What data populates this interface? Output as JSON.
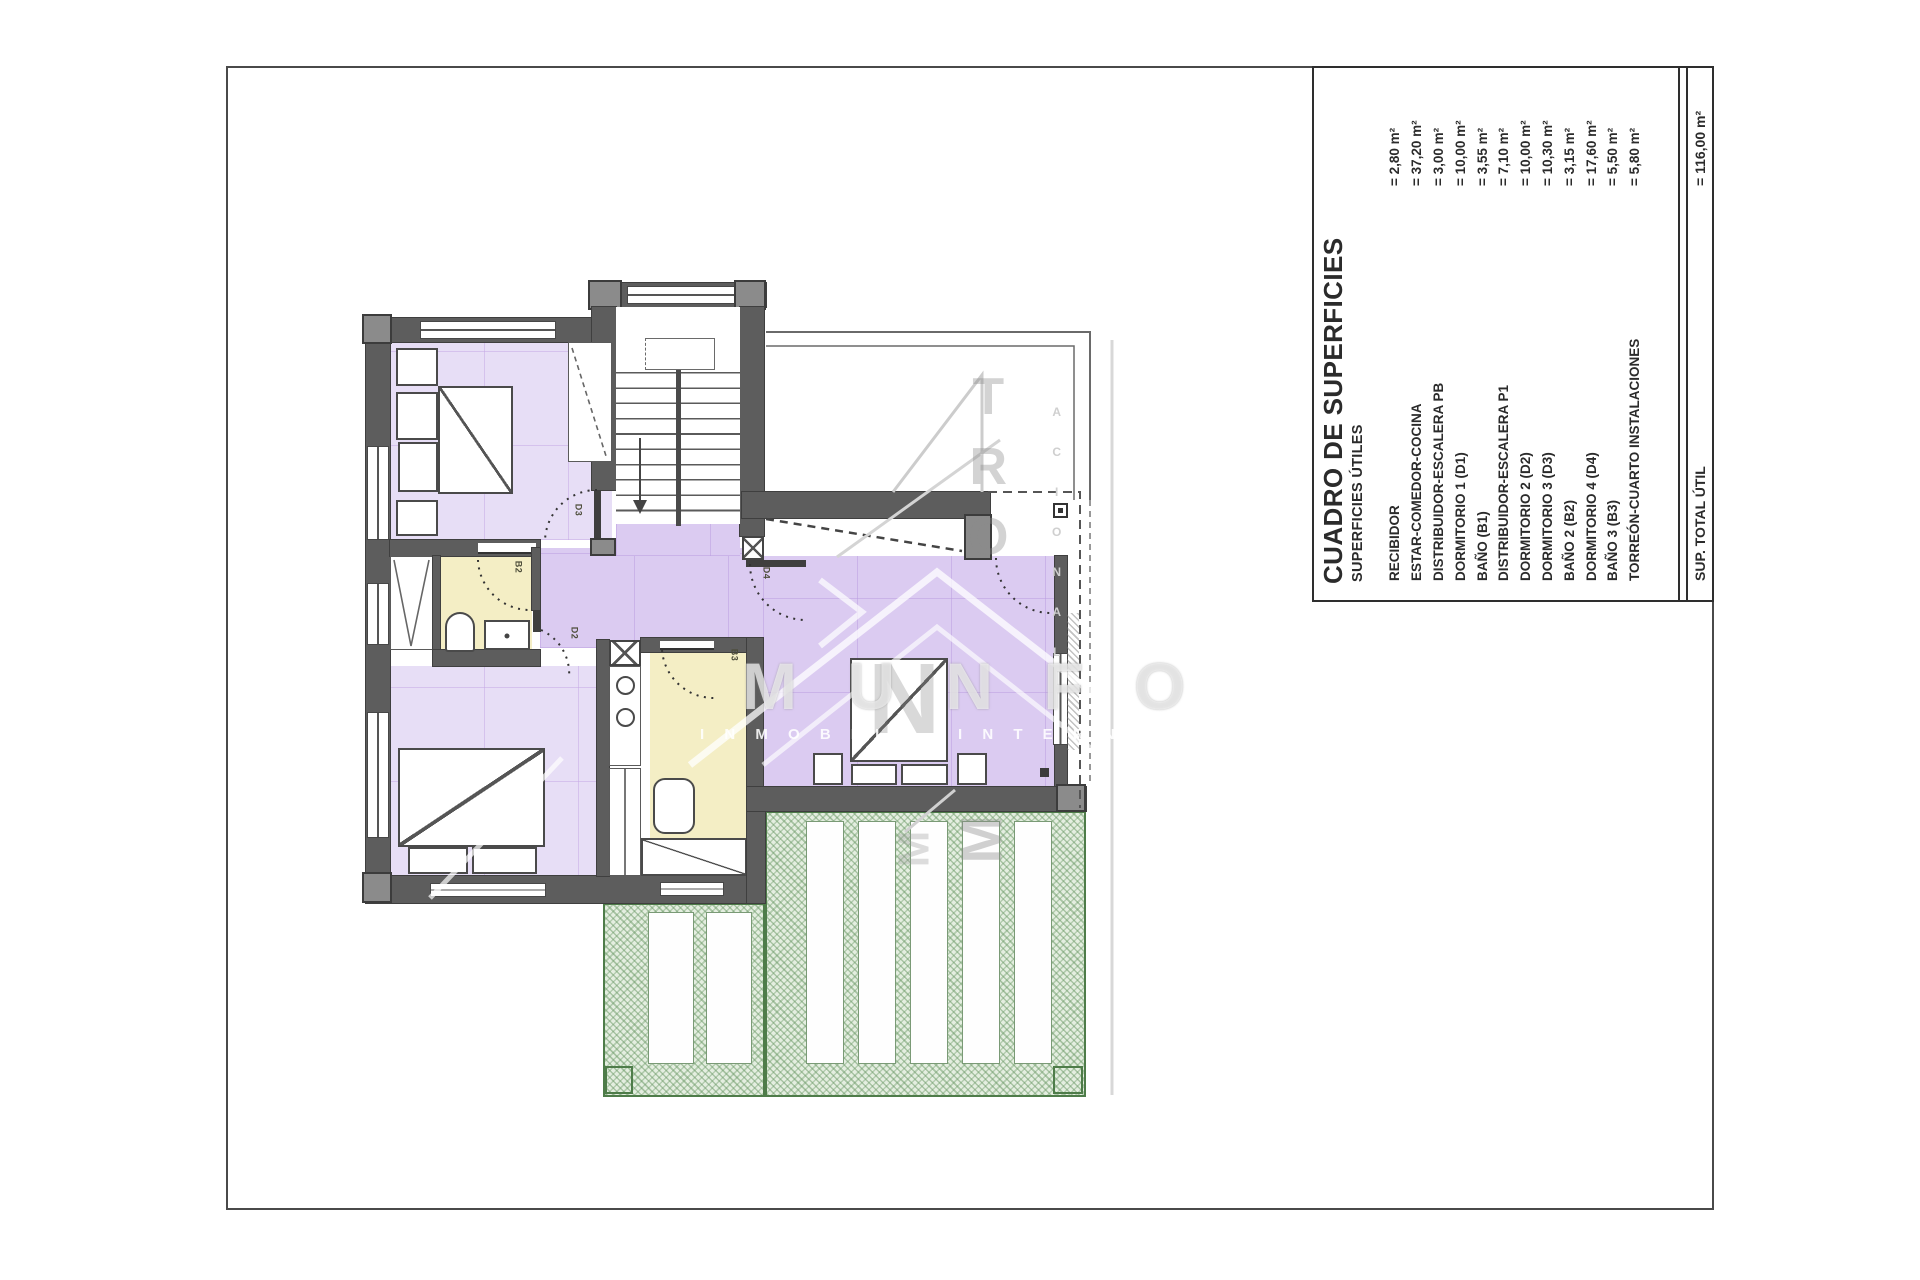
{
  "table": {
    "title": "CUADRO DE SUPERFICIES",
    "subtitle": "SUPERFICIES ÚTILES",
    "rows": [
      {
        "label": "RECIBIDOR",
        "value": "= 2,80 m²"
      },
      {
        "label": "ESTAR-COMEDOR-COCINA",
        "value": "= 37,20 m²"
      },
      {
        "label": "DISTRIBUIDOR-ESCALERA PB",
        "value": "= 3,00 m²"
      },
      {
        "label": "DORMITORIO 1 (D1)",
        "value": "= 10,00 m²"
      },
      {
        "label": "BAÑO  (B1)",
        "value": "= 3,55 m²"
      },
      {
        "label": "DISTRIBUIDOR-ESCALERA P1",
        "value": "= 7,10 m²"
      },
      {
        "label": "DORMITORIO 2 (D2)",
        "value": "= 10,00 m²"
      },
      {
        "label": "DORMITORIO 3 (D3)",
        "value": "= 10,30 m²"
      },
      {
        "label": "BAÑO 2 (B2)",
        "value": "= 3,15 m²"
      },
      {
        "label": "DORMITORIO 4 (D4)",
        "value": "= 17,60 m²"
      },
      {
        "label": "BAÑO 3 (B3)",
        "value": "= 5,50 m²"
      },
      {
        "label": "TORREÓN-CUARTO INSTALACIONES",
        "value": "= 5,80 m²"
      }
    ],
    "total_label": "SUP. TOTAL ÚTIL",
    "total_value": "= 116,00 m²"
  },
  "plan": {
    "door_labels": {
      "d3": "D3",
      "b2": "B2",
      "d2": "D2",
      "b3": "B3",
      "d4": "D4"
    },
    "colors": {
      "wall": "#5d5d5d",
      "room_lavender": "#e7def6",
      "room_lavender_deep": "#dbcbf1",
      "bath_yellow": "#f4eec5",
      "terrace_green": "#4e7c49"
    }
  },
  "watermark": {
    "word_horizontal": "M U N F O",
    "letter_big_n": "N",
    "column_letters_1": "T",
    "column_letters_2": "R",
    "column_letters_3": "O",
    "letter_m_side_1": "M",
    "letter_m_side_2": "M",
    "row_inmobiliaria": "I N M O B I L",
    "row_internacional": "I N T E R N A",
    "column_small": [
      "A",
      "C",
      "I",
      "O",
      "N",
      "A",
      "L"
    ]
  }
}
